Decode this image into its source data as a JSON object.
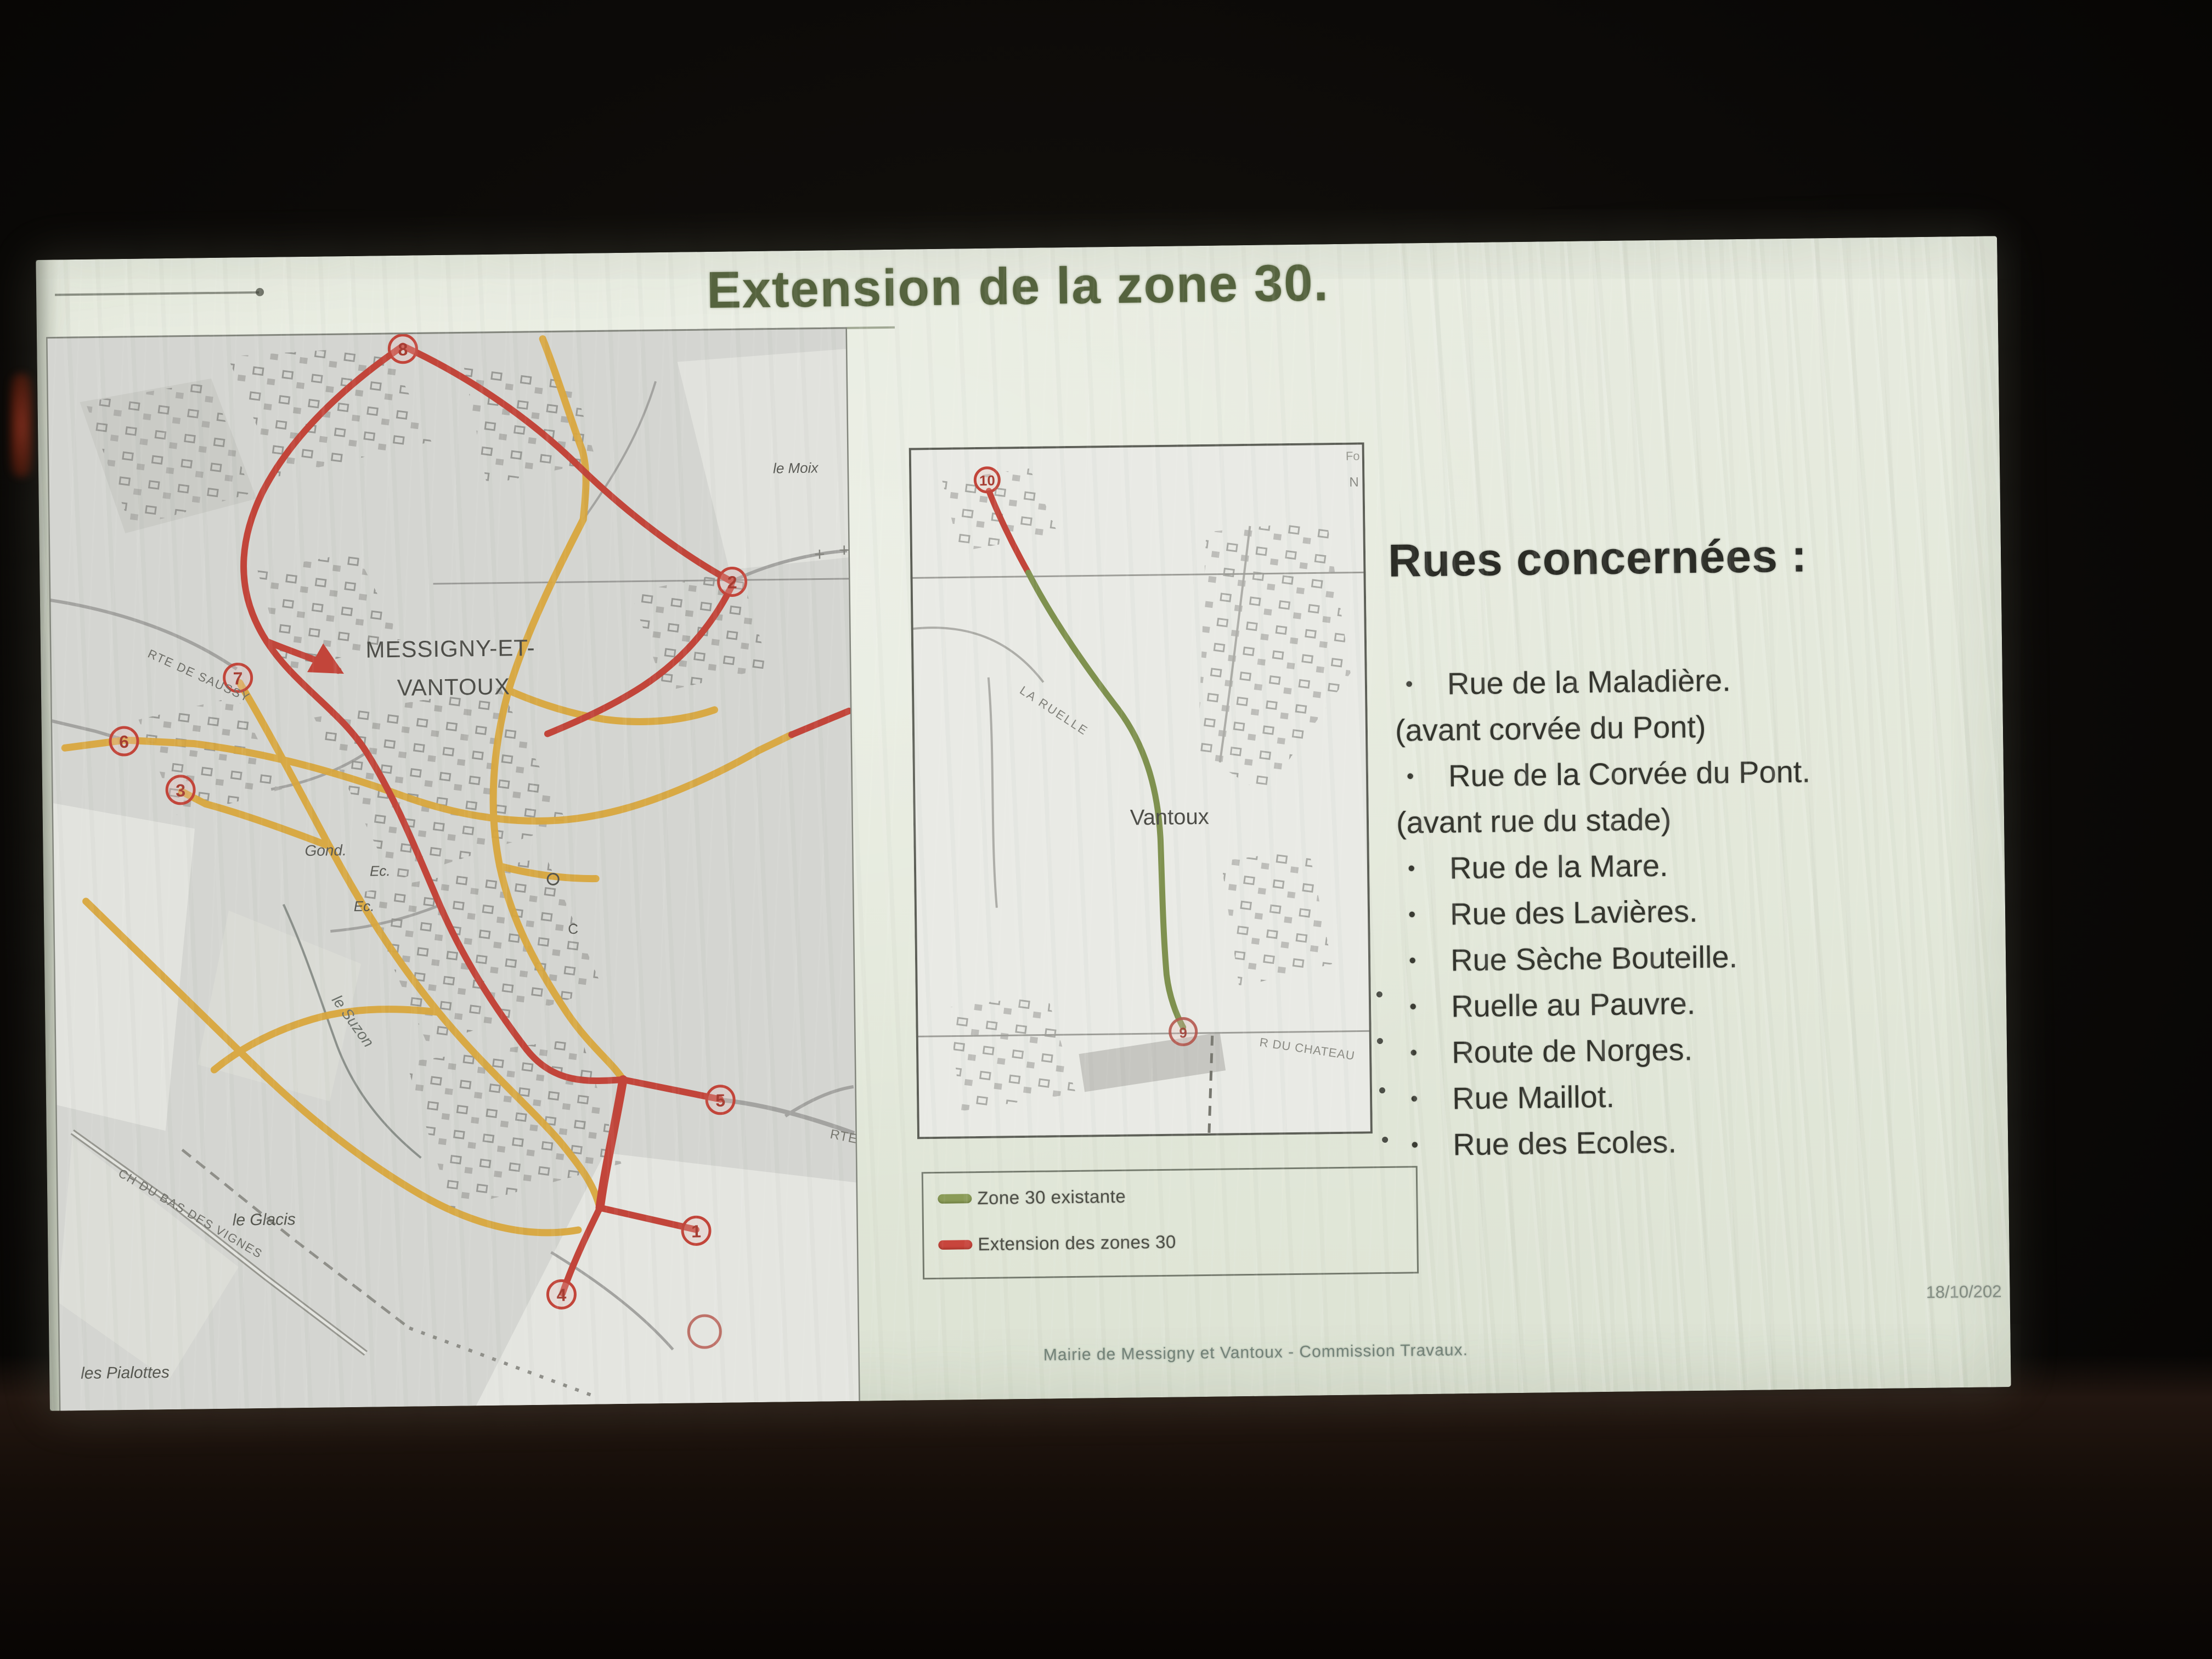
{
  "slide": {
    "title": "Extension de la zone 30.",
    "footer": "Mairie de Messigny et Vantoux - Commission Travaux.",
    "date": "18/10/202"
  },
  "rues": {
    "heading": "Rues concernées :",
    "items": [
      {
        "bullet": true,
        "text": "Rue de la Maladière."
      },
      {
        "bullet": false,
        "text": "(avant corvée du Pont)"
      },
      {
        "bullet": true,
        "text": "Rue de la Corvée du Pont."
      },
      {
        "bullet": false,
        "text": "(avant rue du stade)"
      },
      {
        "bullet": true,
        "text": "Rue de la Mare."
      },
      {
        "bullet": true,
        "text": "Rue des Lavières."
      },
      {
        "bullet": true,
        "text": "Rue Sèche Bouteille."
      },
      {
        "bullet": true,
        "text": "Ruelle au Pauvre."
      },
      {
        "bullet": true,
        "text": "Route de Norges."
      },
      {
        "bullet": true,
        "text": "Rue Maillot."
      },
      {
        "bullet": true,
        "text": "Rue des Ecoles."
      }
    ]
  },
  "legend": {
    "existing": "Zone 30 existante",
    "extension": "Extension des zones 30",
    "existing_color": "#8a9b57",
    "extension_color": "#c8453c"
  },
  "map_left": {
    "labels": {
      "town_line1": "MESSIGNY-ET-",
      "town_line2": "VANTOUX",
      "rte_saussy": "RTE DE SAUSSY",
      "gond": "Gond.",
      "ec1": "Ec.",
      "ec2": "Ec.",
      "suzon": "le Suzon",
      "glacis": "le Glacis",
      "pialottes": "les Pialottes",
      "vignes": "CH DU BAS DES VIGNES",
      "moix": "le Moix",
      "rte_d": "RTE D",
      "c_mark": "C"
    },
    "circles": {
      "n1": "1",
      "n2": "2",
      "n3": "3",
      "n4": "4",
      "n5": "5",
      "n6": "6",
      "n7": "7",
      "n8": "8"
    }
  },
  "map_middle": {
    "labels": {
      "town": "Vantoux",
      "ruelle": "LA RUELLE",
      "chateau": "R DU CHATEAU",
      "fo": "Fo",
      "n": "N"
    },
    "circles": {
      "n9": "9",
      "n10": "10"
    }
  },
  "colors": {
    "title_olive": "#55633e",
    "zone30_green": "#7f914f",
    "extension_red": "#c43b2e",
    "road_yellow": "#d9a73e"
  }
}
